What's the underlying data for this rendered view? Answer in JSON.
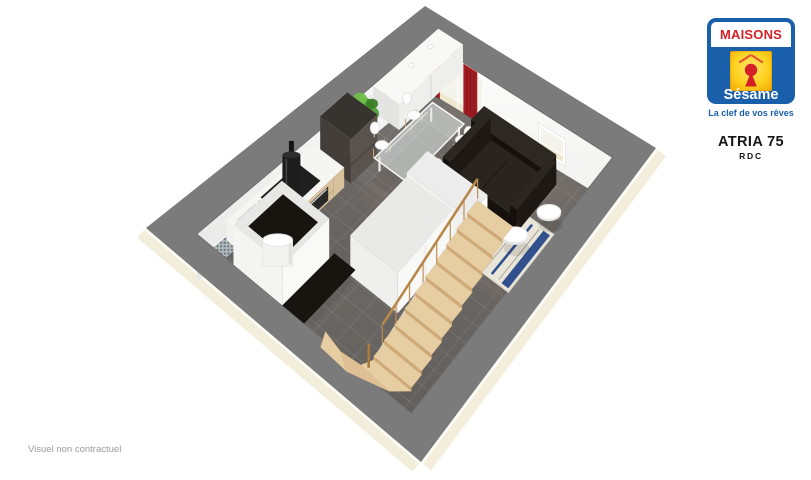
{
  "branding": {
    "brand_top": "MAISONS",
    "brand_bottom": "Sésame",
    "tagline": "La clef de vos rêves",
    "colors": {
      "blue": "#1A5FA9",
      "red": "#D42027",
      "yellow1": "#FFE36B",
      "yellow2": "#F6A400"
    }
  },
  "plan_header": {
    "model": "ATRIA 75",
    "level": "RDC"
  },
  "footer": {
    "disclaimer": "Visuel non contractuel"
  },
  "floorplan": {
    "corners": {
      "T": [
        425,
        6
      ],
      "R": [
        656,
        148
      ],
      "B": [
        421,
        462
      ],
      "L": [
        146,
        228
      ]
    },
    "walls": {
      "ms": 0.105,
      "mt": 0.08,
      "dropT": 52,
      "dropR": 46,
      "dropL": 48
    },
    "colors": {
      "wall_top": "#7b7b7b",
      "wall_top_edge": "#6e6e6e",
      "exterior_cream": "#f3eedb",
      "exterior_white_line": "#fdfdf6",
      "glass": "#f4f4ec",
      "frame_white": "#ffffff",
      "sill_cream": "#efe8d0",
      "curtain": "#a31e23",
      "curtain_dark": "#7c151a",
      "art_yellow": "#c8d829",
      "art_dark": "#6d7a1d",
      "mosaic_base": "#b4bcbf",
      "mosaic_dot": "#67727a",
      "grout": "rgba(255,255,255,0.10)",
      "stairs_wood": "#e7cda2",
      "stairs_riser": "#cfa976",
      "stairs_rail": "#bf8f52",
      "sofa": "#2a241f",
      "sofa_dark": "#16110d",
      "rug_base": "#e9e5d8",
      "rug_stripe": "#31508d",
      "rug_stripe2": "#aaa69a",
      "counter_top": "#f5f5f2",
      "counter_wood": "#d8c09b",
      "partition": "#f9f9f8",
      "partition_top": "#e7e7e5",
      "opening_dark": "#18140f",
      "plant": "#4f9c35",
      "plant_dark": "#3b7d27"
    },
    "wall_features": {
      "patio_door": {
        "u": [
          0.03,
          0.3
        ]
      },
      "curtains": [
        {
          "u": [
            0.0,
            0.068
          ]
        },
        {
          "u": [
            0.195,
            0.27
          ]
        }
      ],
      "window": {
        "u": [
          0.6,
          0.745
        ]
      },
      "artworks": [
        {
          "u0": 0.055
        },
        {
          "u0": 0.15
        },
        {
          "u0": 0.245
        }
      ],
      "mosaic": {
        "u": [
          0.5,
          0.965
        ]
      }
    },
    "furniture": [
      {
        "name": "sideboard",
        "kind": "box",
        "s": [
          0.175,
          0.28
        ],
        "t": [
          0.1,
          0.34
        ],
        "h": 26,
        "top": "#f8f8f6",
        "side": "#eeeeec",
        "side2": "#e4e4e2"
      },
      {
        "name": "sideboard-decor",
        "kind": "dots",
        "items": [
          {
            "at": [
              0.21,
              0.16
            ],
            "dy": 28,
            "r": 3
          },
          {
            "at": [
              0.215,
              0.235
            ],
            "dy": 28,
            "r": 2.5
          }
        ]
      },
      {
        "name": "plant",
        "kind": "plant",
        "at": [
          0.205,
          0.405
        ]
      },
      {
        "name": "fridge",
        "kind": "box",
        "s": [
          0.18,
          0.3
        ],
        "t": [
          0.44,
          0.54
        ],
        "h": 44,
        "top": "#37332f",
        "side": "#5a534d",
        "side2": "#433e3a"
      },
      {
        "name": "kitchen-counter",
        "kind": "counter",
        "s": [
          0.175,
          0.295
        ],
        "t": [
          0.56,
          0.88
        ],
        "h": 20
      },
      {
        "name": "range-hood",
        "kind": "hood",
        "at": [
          0.215,
          0.68
        ]
      },
      {
        "name": "dining-set",
        "kind": "table",
        "s": [
          0.33,
          0.46
        ],
        "t": [
          0.26,
          0.48
        ],
        "chairs": [
          [
            0.302,
            0.305
          ],
          [
            0.302,
            0.425
          ],
          [
            0.478,
            0.285
          ],
          [
            0.478,
            0.405
          ]
        ]
      },
      {
        "name": "rug",
        "kind": "rug",
        "s": [
          0.6,
          0.9
        ],
        "t": [
          0.33,
          0.52
        ]
      },
      {
        "name": "sofa",
        "kind": "sofa",
        "s": [
          0.5,
          0.8
        ],
        "t": [
          0.22,
          0.38
        ]
      },
      {
        "name": "coffee-table-large",
        "kind": "disc",
        "at": [
          0.865,
          0.315
        ],
        "r": 12
      },
      {
        "name": "coffee-table-small",
        "kind": "disc",
        "at": [
          0.825,
          0.415
        ],
        "r": 13
      },
      {
        "name": "stair-head-wall",
        "kind": "box",
        "s": [
          0.5,
          0.74
        ],
        "t": [
          0.44,
          0.52
        ],
        "h": 44,
        "top": "#ececec",
        "side": "#fbfbfa",
        "side2": "#f1f1ef"
      },
      {
        "name": "under-stair-closet",
        "kind": "box",
        "s": [
          0.5,
          0.68
        ],
        "t": [
          0.52,
          0.74
        ],
        "h": 40,
        "top": "#e9e9e7",
        "side": "#f8f8f6",
        "side2": "#efefed"
      },
      {
        "name": "hall-opening",
        "kind": "flat",
        "s": [
          0.42,
          0.5
        ],
        "t": [
          0.72,
          0.92
        ],
        "fill": "#18140f"
      },
      {
        "name": "wc-room",
        "kind": "room",
        "s": [
          0.24,
          0.42
        ],
        "t": [
          0.74,
          0.92
        ],
        "h": 40
      },
      {
        "name": "water-heater",
        "kind": "cylinder",
        "at": [
          0.33,
          0.845
        ],
        "r": 15,
        "h": 26
      },
      {
        "name": "staircase",
        "kind": "stairs",
        "s": [
          0.72,
          0.86
        ],
        "t": [
          0.46,
          0.88
        ]
      }
    ]
  }
}
